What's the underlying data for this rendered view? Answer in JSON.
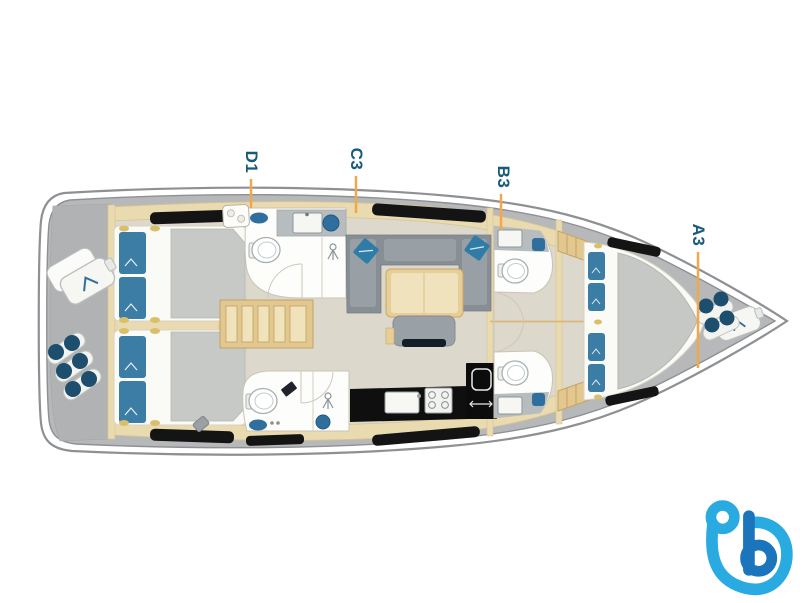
{
  "canvas": {
    "width_px": 805,
    "height_px": 603,
    "background": "#ffffff"
  },
  "floorplan": {
    "type": "sailing-yacht-interior-deck-plan",
    "orientation": "bow-right",
    "labels": [
      {
        "id": "D1"
      },
      {
        "id": "C3"
      },
      {
        "id": "B3"
      },
      {
        "id": "A3"
      }
    ],
    "label_style": {
      "color": "#175a7c",
      "leader_color": "#f2a74b",
      "rotation_deg": 90
    },
    "colors": {
      "hull_line": "#8e9093",
      "deck": "#b6b8b9",
      "deck_inner": "#b0b2b3",
      "cabinetry": "#eadab0",
      "floor": "#dcd8cb",
      "wood": "#e7cd96",
      "stairs": "#e2c78e",
      "sofa": "#878e94",
      "seat": "#99a0a5",
      "mattress": "#c5c8c4",
      "linen": "#fafaf7",
      "pillow": "#3b7da4",
      "bathroom": "#fdfdfb",
      "counter": "#b7bcbe",
      "fixture_blue": "#2e6f9e",
      "hatch_black": "#141414",
      "fender_navy": "#1d4e6e",
      "gold_trim": "#d8c06a"
    },
    "components": [
      "double-bed",
      "pillow",
      "duvet",
      "toilet",
      "shower-head",
      "washbasin",
      "galley-sink",
      "stove",
      "fridge",
      "companionway-stairs",
      "sofa",
      "saloon-table",
      "tv-bench",
      "deck-hatch",
      "skylight",
      "fender",
      "fender-bag",
      "door-swing",
      "centerline"
    ]
  },
  "branding": {
    "logo": "boataround-b-logo",
    "logo_color_light": "#29abe2",
    "logo_color_dark": "#1b75bc"
  }
}
